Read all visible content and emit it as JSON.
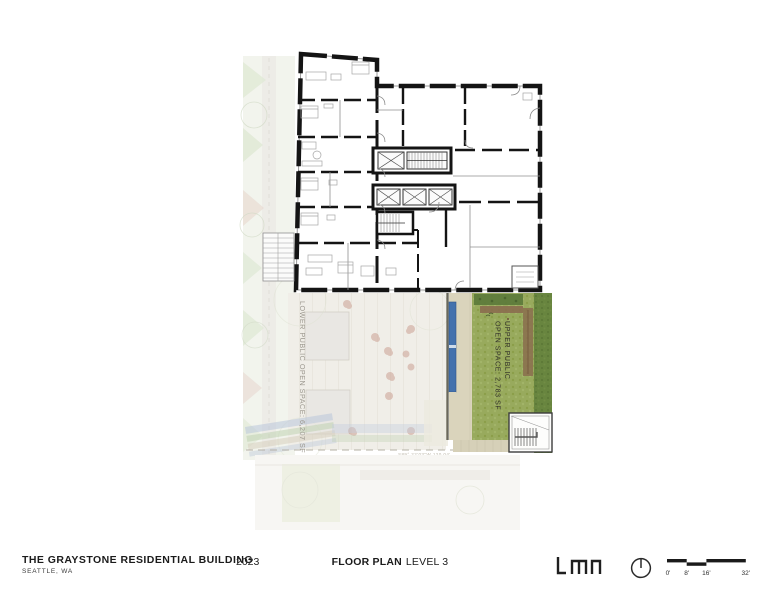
{
  "sheet": {
    "footer": {
      "project_title": "THE GRAYSTONE RESIDENTIAL BUILDING",
      "project_location": "SEATTLE, WA",
      "year": "2023",
      "drawing_title_bold": "FLOOR PLAN",
      "drawing_title_regular": "LEVEL 3",
      "firm_logo_text": "lmn",
      "scale_labels": [
        "0'",
        "8'",
        "16'",
        "32'"
      ]
    },
    "plan": {
      "upper_open_space_label_line1": "UPPER PUBLIC",
      "upper_open_space_label_line2": "OPEN SPACE: 2,783 SF",
      "lower_open_space_label": "LOWER PUBLIC OPEN SPACE: 6,207 SF",
      "property_line_label": "S89° 22'03\"W 120.04'",
      "colors": {
        "wall": "#141414",
        "grass": "#98aa5d",
        "grass_dark": "#68853f",
        "water": "#4472ad",
        "walkway": "#d9d3bb",
        "planter_brown": "#8a6a4d"
      }
    }
  }
}
